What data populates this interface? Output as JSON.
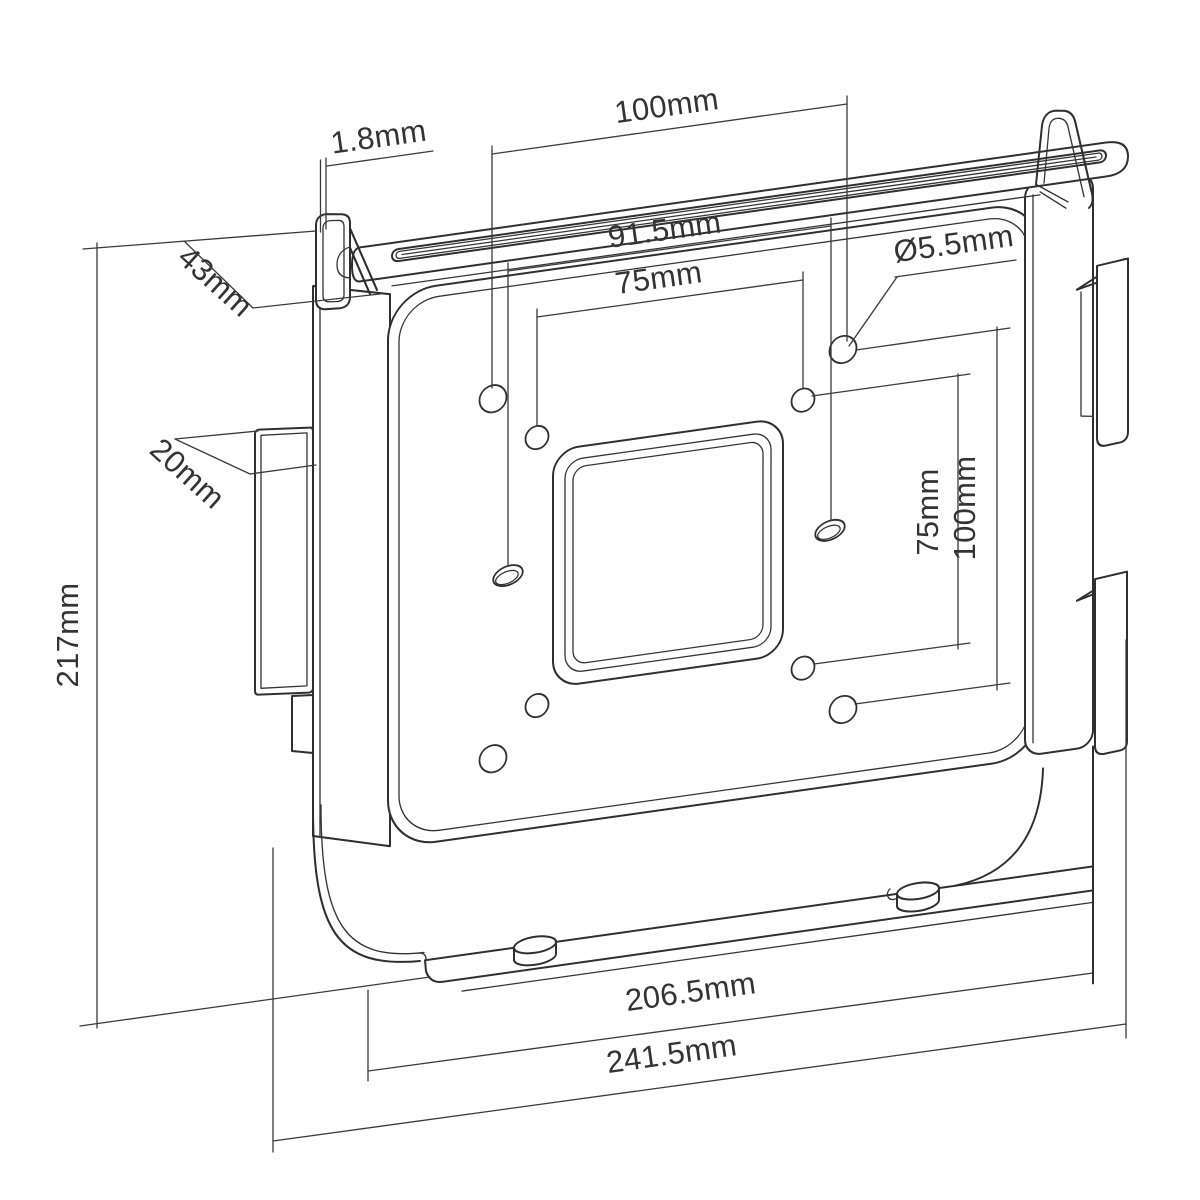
{
  "drawing": {
    "type": "technical-drawing",
    "subject": "VESA mount bracket (isometric line drawing)",
    "background": "#ffffff",
    "line_color": "#2f2f2f",
    "text_color": "#333333",
    "units": "mm",
    "dimensions": {
      "thickness": "1.8mm",
      "vesa100_h": "100mm",
      "slot_span": "91.5mm",
      "vesa75_h": "75mm",
      "hole_dia": "Ø5.5mm",
      "top_clamp_depth": "43mm",
      "side_clamp_depth": "20mm",
      "height": "217mm",
      "vesa75_v": "75mm",
      "vesa100_v": "100mm",
      "inner_width": "206.5mm",
      "overall_width": "241.5mm"
    }
  }
}
